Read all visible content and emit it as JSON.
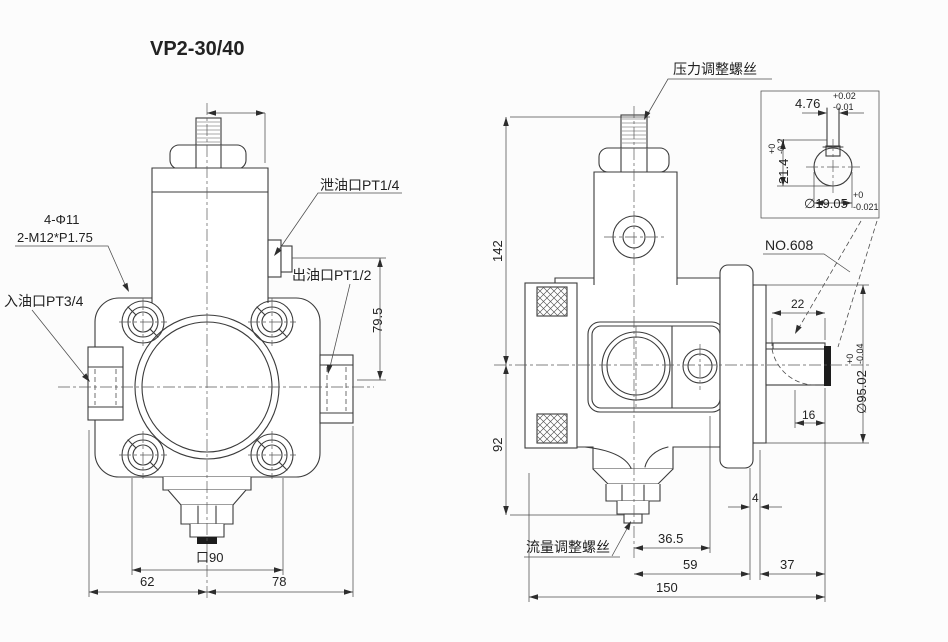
{
  "title": "VP2-30/40",
  "front_view": {
    "bolt_spec_line1": "4-Φ11",
    "bolt_spec_line2": "2-M12*P1.75",
    "inlet_port_label": "入油口PT3/4",
    "drain_port_label": "泄油口PT1/4",
    "outlet_port_label": "出油口PT1/2",
    "dim_port_height": "79.5",
    "dim_square": "口90",
    "dim_left": "62",
    "dim_right": "78"
  },
  "side_view": {
    "pressure_screw_label": "压力调整螺丝",
    "flow_screw_label": "流量调整螺丝",
    "bearing_label": "NO.608",
    "dim_height_upper": "142",
    "dim_height_lower": "92",
    "dim_key_length": "22",
    "dim_key_end": "16",
    "dim_step": "4",
    "dim_center_to_port_face": "36.5",
    "dim_center_to_rear": "59",
    "dim_rear_to_shaft_end": "37",
    "dim_total_length": "150",
    "dim_pilot_dia": "∅95.02",
    "pilot_tol_upper": "+0",
    "pilot_tol_lower": "-0.04"
  },
  "detail_view": {
    "dim_key_width": "4.76",
    "key_width_tol_upper": "+0.02",
    "key_width_tol_lower": "-0.01",
    "dim_key_height": "21.4",
    "key_height_tol_upper": "+0",
    "key_height_tol_lower": "-0.2",
    "dim_shaft_dia": "∅19.05",
    "shaft_dia_tol_upper": "+0",
    "shaft_dia_tol_lower": "-0.021"
  }
}
